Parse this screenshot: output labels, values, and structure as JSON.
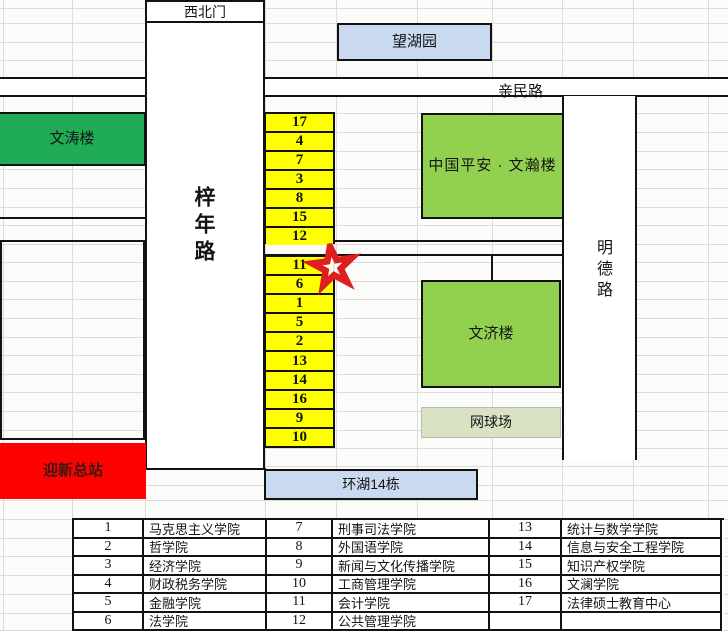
{
  "roads": {
    "northwest_gate": "西北门",
    "zinian_road": "梓年路",
    "qinmin_road": "亲民路",
    "mingde_road": "明德路"
  },
  "buildings": {
    "wanghu_garden": "望湖园",
    "wentao_building": "文涛楼",
    "wenhan_building": "中国平安 · 文瀚楼",
    "wenji_building": "文济楼",
    "tennis_court": "网球场",
    "welcome_station": "迎新总站",
    "huanhu_building14": "环湖14栋"
  },
  "numbers_north": [
    "17",
    "4",
    "7",
    "3",
    "8",
    "15",
    "12"
  ],
  "numbers_south": [
    "11",
    "6",
    "1",
    "5",
    "2",
    "13",
    "14",
    "16",
    "9",
    "10"
  ],
  "colors": {
    "cell_yellow": "#ffff00",
    "bright_green": "#20ab55",
    "medium_green": "#92d050",
    "pale_green": "#d9e2c2",
    "light_blue": "#c9d9ef",
    "station_red": "#fe0101",
    "station_text": "#3c1812",
    "star_red": "#dd1f1f"
  },
  "legend": {
    "entries": [
      {
        "num": "1",
        "name": "马克思主义学院"
      },
      {
        "num": "2",
        "name": "哲学院"
      },
      {
        "num": "3",
        "name": "经济学院"
      },
      {
        "num": "4",
        "name": "财政税务学院"
      },
      {
        "num": "5",
        "name": "金融学院"
      },
      {
        "num": "6",
        "name": "法学院"
      },
      {
        "num": "7",
        "name": "刑事司法学院"
      },
      {
        "num": "8",
        "name": "外国语学院"
      },
      {
        "num": "9",
        "name": "新闻与文化传播学院"
      },
      {
        "num": "10",
        "name": "工商管理学院"
      },
      {
        "num": "11",
        "name": "会计学院"
      },
      {
        "num": "12",
        "name": "公共管理学院"
      },
      {
        "num": "13",
        "name": "统计与数学学院"
      },
      {
        "num": "14",
        "name": "信息与安全工程学院"
      },
      {
        "num": "15",
        "name": "知识产权学院"
      },
      {
        "num": "16",
        "name": "文澜学院"
      },
      {
        "num": "17",
        "name": "法律硕士教育中心"
      }
    ],
    "rows": 6,
    "columns": 3
  }
}
